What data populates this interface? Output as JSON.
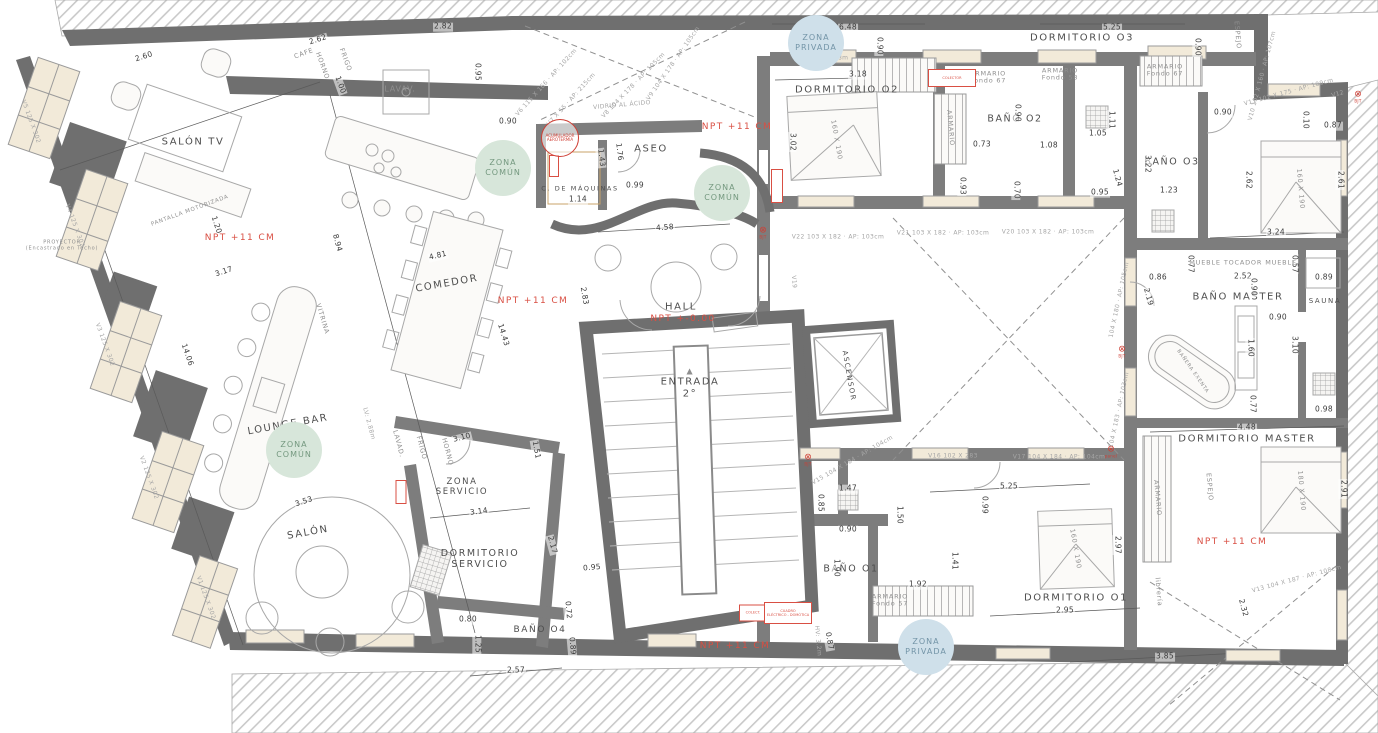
{
  "title": "Planta 2 - Distribución vivienda",
  "palette": {
    "wall": "#6f6f6f",
    "wall_inner": "#7d7d7d",
    "hatch": "#c9c9c9",
    "window_fill": "#f2ead9",
    "furniture": "#a8a8a8",
    "zone_common_bg": "#d7e6da",
    "zone_common_text": "#74987f",
    "zone_private_bg": "#cfe0ea",
    "zone_private_text": "#7394a7",
    "red": "#d94f43",
    "label": "#4e4e4e",
    "dim": "#3a3a3a",
    "tag": "#a6a6a6"
  },
  "rooms": [
    {
      "n": "room-salon-tv",
      "t": "SALÓN TV",
      "x": 193,
      "y": 142
    },
    {
      "n": "room-comedor",
      "t": "COMEDOR",
      "x": 447,
      "y": 284,
      "a": -10
    },
    {
      "n": "room-lounge-bar",
      "t": "LOUNGE BAR",
      "x": 288,
      "y": 425,
      "a": -10
    },
    {
      "n": "room-salon",
      "t": "SALÓN",
      "x": 308,
      "y": 533,
      "a": -10
    },
    {
      "n": "room-aseo",
      "t": "ASEO",
      "x": 651,
      "y": 149
    },
    {
      "n": "room-c-maquinas",
      "t": "C. DE MÁQUINAS",
      "x": 580,
      "y": 189,
      "s": 6.5
    },
    {
      "n": "room-hall",
      "t": "HALL",
      "x": 681,
      "y": 307
    },
    {
      "n": "room-entrada",
      "lines": [
        "ENTRADA",
        "2°"
      ],
      "x": 690,
      "y": 388
    },
    {
      "n": "room-ascensor",
      "t": "ASCENSOR",
      "x": 849,
      "y": 376,
      "a": 80,
      "s": 7
    },
    {
      "n": "room-zona-servicio",
      "lines": [
        "ZONA",
        "SERVICIO"
      ],
      "x": 462,
      "y": 488,
      "s": 8.5
    },
    {
      "n": "room-dormitorio-servicio",
      "lines": [
        "DORMITORIO",
        "SERVICIO"
      ],
      "x": 480,
      "y": 560,
      "s": 9.5
    },
    {
      "n": "room-bano-o4",
      "t": "BAÑO O4",
      "x": 540,
      "y": 630,
      "s": 9
    },
    {
      "n": "room-dormitorio-o2",
      "t": "DORMITORIO O2",
      "x": 847,
      "y": 90
    },
    {
      "n": "room-bano-o2",
      "t": "BAÑO O2",
      "x": 1015,
      "y": 120,
      "s": 9.5
    },
    {
      "n": "room-dormitorio-o3",
      "t": "DORMITORIO O3",
      "x": 1082,
      "y": 38
    },
    {
      "n": "room-bano-o3",
      "t": "BAÑO O3",
      "x": 1172,
      "y": 163,
      "s": 9.5
    },
    {
      "n": "room-bano-master",
      "t": "BAÑO MASTER",
      "x": 1238,
      "y": 297
    },
    {
      "n": "room-sauna",
      "t": "SAUNA",
      "x": 1325,
      "y": 301,
      "s": 7
    },
    {
      "n": "room-dormitorio-master",
      "t": "DORMITORIO MASTER",
      "x": 1247,
      "y": 439
    },
    {
      "n": "room-bano-o1",
      "t": "BAÑO O1",
      "x": 851,
      "y": 570,
      "s": 9.5
    },
    {
      "n": "room-dormitorio-o1",
      "t": "DORMITORIO O1",
      "x": 1076,
      "y": 598
    }
  ],
  "zones": [
    {
      "n": "zone-comun-cocina",
      "l1": "ZONA",
      "l2": "COMÚN",
      "x": 503,
      "y": 168,
      "type": "common"
    },
    {
      "n": "zone-comun-hall",
      "l1": "ZONA",
      "l2": "COMÚN",
      "x": 722,
      "y": 193,
      "type": "common"
    },
    {
      "n": "zone-comun-lounge",
      "l1": "ZONA",
      "l2": "COMÚN",
      "x": 294,
      "y": 450,
      "type": "common"
    },
    {
      "n": "zone-privada-top",
      "l1": "ZONA",
      "l2": "PRIVADA",
      "x": 816,
      "y": 43,
      "type": "private"
    },
    {
      "n": "zone-privada-bottom",
      "l1": "ZONA",
      "l2": "PRIVADA",
      "x": 926,
      "y": 647,
      "type": "private"
    }
  ],
  "npt": [
    {
      "t": "NPT +11 CM",
      "x": 240,
      "y": 238
    },
    {
      "t": "NPT +11 CM",
      "x": 533,
      "y": 301
    },
    {
      "t": "NPT +11 CM",
      "x": 737,
      "y": 127
    },
    {
      "t": "NPT +11 CM",
      "x": 735,
      "y": 646
    },
    {
      "t": "NPT +11 CM",
      "x": 1232,
      "y": 542
    },
    {
      "t": "NPT +-0.00",
      "x": 683,
      "y": 319
    }
  ],
  "dims": [
    {
      "t": "2.82",
      "x": 443,
      "y": 27
    },
    {
      "t": "2.62",
      "x": 318,
      "y": 40,
      "a": -18
    },
    {
      "t": "2.60",
      "x": 144,
      "y": 57,
      "a": -18
    },
    {
      "t": "1.00",
      "x": 340,
      "y": 85,
      "a": 70
    },
    {
      "t": "0.95",
      "x": 477,
      "y": 72,
      "a": 90
    },
    {
      "t": "0.90",
      "x": 508,
      "y": 122
    },
    {
      "t": "1.20",
      "x": 216,
      "y": 225,
      "a": 72
    },
    {
      "t": "8.94",
      "x": 337,
      "y": 243,
      "a": 75
    },
    {
      "t": "3.17",
      "x": 224,
      "y": 272,
      "a": -18
    },
    {
      "t": "14.06",
      "x": 187,
      "y": 355,
      "a": 71
    },
    {
      "t": "14.43",
      "x": 503,
      "y": 335,
      "a": 73
    },
    {
      "t": "4.81",
      "x": 438,
      "y": 256,
      "a": -13
    },
    {
      "t": "2.83",
      "x": 584,
      "y": 296,
      "a": 80
    },
    {
      "t": "4.58",
      "x": 665,
      "y": 228,
      "a": -4
    },
    {
      "t": "1.14",
      "x": 578,
      "y": 200
    },
    {
      "t": "0.99",
      "x": 635,
      "y": 186
    },
    {
      "t": "1.76",
      "x": 619,
      "y": 152,
      "a": 83
    },
    {
      "t": "1.43",
      "x": 601,
      "y": 158,
      "a": 83
    },
    {
      "t": "1.16",
      "x": 831,
      "y": 45
    },
    {
      "t": "6.48",
      "x": 848,
      "y": 28
    },
    {
      "t": "0.90",
      "x": 879,
      "y": 46,
      "a": 90
    },
    {
      "t": "3.18",
      "x": 858,
      "y": 75
    },
    {
      "t": "3.02",
      "x": 792,
      "y": 142,
      "a": 90
    },
    {
      "t": "5.25",
      "x": 1112,
      "y": 28
    },
    {
      "t": "0.90",
      "x": 1197,
      "y": 47,
      "a": 90
    },
    {
      "t": "0.73",
      "x": 982,
      "y": 145
    },
    {
      "t": "1.08",
      "x": 1049,
      "y": 146
    },
    {
      "t": "0.90",
      "x": 1017,
      "y": 113,
      "a": 90
    },
    {
      "t": "0.70",
      "x": 1016,
      "y": 190,
      "a": 90
    },
    {
      "t": "1.05",
      "x": 1098,
      "y": 134
    },
    {
      "t": "1.11",
      "x": 1111,
      "y": 120,
      "a": 90
    },
    {
      "t": "0.95",
      "x": 1100,
      "y": 193
    },
    {
      "t": "0.93",
      "x": 962,
      "y": 186,
      "a": 90
    },
    {
      "t": "1.23",
      "x": 1169,
      "y": 191
    },
    {
      "t": "3.22",
      "x": 1147,
      "y": 164,
      "a": 90
    },
    {
      "t": "1.24",
      "x": 1117,
      "y": 178,
      "a": 75
    },
    {
      "t": "0.90",
      "x": 1223,
      "y": 113
    },
    {
      "t": "0.10",
      "x": 1305,
      "y": 120,
      "a": 90
    },
    {
      "t": "0.87",
      "x": 1333,
      "y": 126
    },
    {
      "t": "2.62",
      "x": 1248,
      "y": 180,
      "a": 90
    },
    {
      "t": "2.61",
      "x": 1340,
      "y": 180,
      "a": 90
    },
    {
      "t": "3.24",
      "x": 1276,
      "y": 233
    },
    {
      "t": "0.86",
      "x": 1158,
      "y": 278
    },
    {
      "t": "0.77",
      "x": 1190,
      "y": 264,
      "a": 90
    },
    {
      "t": "2.52",
      "x": 1243,
      "y": 277
    },
    {
      "t": "0.57",
      "x": 1294,
      "y": 264,
      "a": 90
    },
    {
      "t": "0.89",
      "x": 1324,
      "y": 278
    },
    {
      "t": "0.90",
      "x": 1253,
      "y": 287,
      "a": 90
    },
    {
      "t": "2.19",
      "x": 1148,
      "y": 297,
      "a": 75
    },
    {
      "t": "0.90",
      "x": 1278,
      "y": 318
    },
    {
      "t": "1.60",
      "x": 1250,
      "y": 348,
      "a": 90
    },
    {
      "t": "3.10",
      "x": 1294,
      "y": 345,
      "a": 90
    },
    {
      "t": "0.77",
      "x": 1252,
      "y": 404,
      "a": 90
    },
    {
      "t": "0.98",
      "x": 1324,
      "y": 410
    },
    {
      "t": "4.48",
      "x": 1247,
      "y": 428
    },
    {
      "t": "2.91",
      "x": 1343,
      "y": 489,
      "a": 90
    },
    {
      "t": "2.32",
      "x": 1243,
      "y": 608,
      "a": 75
    },
    {
      "t": "3.85",
      "x": 1165,
      "y": 657
    },
    {
      "t": "5.25",
      "x": 1009,
      "y": 487
    },
    {
      "t": "0.99",
      "x": 984,
      "y": 505,
      "a": 90
    },
    {
      "t": "2.97",
      "x": 1117,
      "y": 545,
      "a": 90
    },
    {
      "t": "2.95",
      "x": 1065,
      "y": 611
    },
    {
      "t": "1.47",
      "x": 848,
      "y": 489
    },
    {
      "t": "0.85",
      "x": 820,
      "y": 503,
      "a": 90
    },
    {
      "t": "1.50",
      "x": 899,
      "y": 515,
      "a": 90
    },
    {
      "t": "0.90",
      "x": 848,
      "y": 530
    },
    {
      "t": "1.90",
      "x": 836,
      "y": 568,
      "a": 90
    },
    {
      "t": "1.92",
      "x": 918,
      "y": 585
    },
    {
      "t": "1.41",
      "x": 954,
      "y": 561,
      "a": 90
    },
    {
      "t": "0.87",
      "x": 829,
      "y": 641,
      "a": 80
    },
    {
      "t": "3.53",
      "x": 304,
      "y": 502,
      "a": -18
    },
    {
      "t": "3.14",
      "x": 479,
      "y": 512,
      "a": -8
    },
    {
      "t": "2.17",
      "x": 552,
      "y": 545,
      "a": 75
    },
    {
      "t": "0.95",
      "x": 592,
      "y": 568,
      "a": -5
    },
    {
      "t": "0.72",
      "x": 568,
      "y": 610,
      "a": 85
    },
    {
      "t": "0.80",
      "x": 468,
      "y": 620
    },
    {
      "t": "1.25",
      "x": 477,
      "y": 644,
      "a": 90
    },
    {
      "t": "2.57",
      "x": 516,
      "y": 671
    },
    {
      "t": "0.89",
      "x": 572,
      "y": 646,
      "a": 85
    },
    {
      "t": "3.10",
      "x": 462,
      "y": 438,
      "a": -14
    },
    {
      "t": "1.51",
      "x": 536,
      "y": 450,
      "a": 80
    }
  ],
  "tags": [
    {
      "t": "V1 125 X 302",
      "x": 205,
      "y": 598,
      "a": 70
    },
    {
      "t": "V2 125 X 302",
      "x": 148,
      "y": 478,
      "a": 70
    },
    {
      "t": "V3 125 X 302",
      "x": 104,
      "y": 345,
      "a": 70
    },
    {
      "t": "V4 125 X 302",
      "x": 74,
      "y": 226,
      "a": 70
    },
    {
      "t": "V5 125 X 302",
      "x": 30,
      "y": 122,
      "a": 70
    },
    {
      "t": "V6 115 X 166 · AP: 102cm",
      "x": 547,
      "y": 83,
      "a": -48
    },
    {
      "t": "V7 X 55 · AP: 215cm",
      "x": 572,
      "y": 100,
      "a": -48
    },
    {
      "t": "V8 104 X 178 · AP: 105cm",
      "x": 634,
      "y": 86,
      "a": -46
    },
    {
      "t": "V9 104 X 178 · AP: 105cm",
      "x": 674,
      "y": 64,
      "a": -55
    },
    {
      "t": "V10 102 X 160 · AP: 107cm",
      "x": 1263,
      "y": 76,
      "a": -75
    },
    {
      "t": "V11 102 X 175 · AP: 109cm",
      "x": 1289,
      "y": 93,
      "a": -15
    },
    {
      "t": "V12",
      "x": 1338,
      "y": 95,
      "a": -15
    },
    {
      "t": "V13 104 X 187 · AP: 108cm",
      "x": 1297,
      "y": 580,
      "a": -15
    },
    {
      "t": "104 X 180 · AP: 105cm",
      "x": 1120,
      "y": 300,
      "a": -78
    },
    {
      "t": "104 X 183 · AP: 103cm",
      "x": 1120,
      "y": 410,
      "a": -78
    },
    {
      "t": "V15 104 X 184 · AP: 104cm",
      "x": 853,
      "y": 461,
      "a": -30
    },
    {
      "t": "V16 102 X 283",
      "x": 953,
      "y": 457
    },
    {
      "t": "V17 104 X 184 · AP: 104cm",
      "x": 1059,
      "y": 458
    },
    {
      "t": "V20 103 X 182 · AP: 103cm",
      "x": 1048,
      "y": 233
    },
    {
      "t": "V21 103 X 182 · AP: 103cm",
      "x": 943,
      "y": 234
    },
    {
      "t": "V22 103 X 182 · AP: 103cm",
      "x": 838,
      "y": 238
    },
    {
      "t": "V19",
      "x": 793,
      "y": 282,
      "a": 85
    },
    {
      "t": "HV: 3.18m",
      "x": 831,
      "y": 59
    },
    {
      "t": "HV: 3.2m",
      "x": 817,
      "y": 641,
      "a": 85
    },
    {
      "t": "LV: 2.88m",
      "x": 368,
      "y": 424,
      "a": 75
    },
    {
      "t": "VIDRIO AL ÁCIDO",
      "x": 622,
      "y": 106,
      "a": -5
    }
  ],
  "fixtures": [
    {
      "n": "fixture-lavavajillas",
      "t": "LAVAV.",
      "x": 400,
      "y": 89,
      "s": 8
    },
    {
      "n": "fixture-cafe",
      "t": "CAFE",
      "x": 304,
      "y": 54,
      "a": -20
    },
    {
      "n": "fixture-frigo",
      "t": "FRIGO",
      "x": 345,
      "y": 60,
      "a": 70
    },
    {
      "n": "fixture-horno",
      "t": "HORNO",
      "x": 322,
      "y": 66,
      "a": 70
    },
    {
      "n": "fixture-lavadora",
      "t": "LAVAD.",
      "x": 398,
      "y": 444,
      "a": 75
    },
    {
      "n": "fixture-frigo-servicio",
      "t": "FRIGO",
      "x": 421,
      "y": 448,
      "a": 75
    },
    {
      "n": "fixture-horno-servicio",
      "t": "HORNO",
      "x": 447,
      "y": 452,
      "a": 75
    },
    {
      "n": "fixture-armario-o2",
      "lines": [
        "ARMARIO",
        "Fondo 67"
      ],
      "x": 988,
      "y": 78
    },
    {
      "n": "fixture-armario-o2b",
      "lines": [
        "ARMARIO",
        "Fondo 58"
      ],
      "x": 1060,
      "y": 75
    },
    {
      "n": "fixture-armario-o3",
      "lines": [
        "ARMARIO",
        "Fondo 67"
      ],
      "x": 1165,
      "y": 71
    },
    {
      "n": "fixture-armario-vert",
      "t": "ARMARIO",
      "x": 950,
      "y": 128,
      "a": 85
    },
    {
      "n": "fixture-armario-o1",
      "lines": [
        "ARMARIO",
        "Fondo 57"
      ],
      "x": 890,
      "y": 601
    },
    {
      "n": "fixture-armario-master",
      "t": "ARMARIO",
      "x": 1157,
      "y": 498,
      "a": 85
    },
    {
      "n": "fixture-espejo-o3",
      "t": "ESPEJO",
      "x": 1237,
      "y": 35,
      "a": 85
    },
    {
      "n": "fixture-espejo-master",
      "t": "ESPEJO",
      "x": 1209,
      "y": 487,
      "a": 85
    },
    {
      "n": "fixture-libreria",
      "t": "librería",
      "x": 1158,
      "y": 592,
      "a": 85
    },
    {
      "n": "fixture-mueble-1",
      "t": "MUEBLE",
      "x": 1205,
      "y": 263
    },
    {
      "n": "fixture-tocador",
      "t": "TOCADOR",
      "x": 1243,
      "y": 263
    },
    {
      "n": "fixture-mueble-2",
      "t": "MUEBLE",
      "x": 1281,
      "y": 263
    },
    {
      "n": "fixture-banera",
      "t": "BAÑERA EXENTA",
      "x": 1192,
      "y": 372,
      "a": 55,
      "s": 5
    },
    {
      "n": "fixture-cama-o2",
      "t": "160 X 190",
      "x": 836,
      "y": 140,
      "a": 80
    },
    {
      "n": "fixture-cama-o3",
      "t": "160 X 190",
      "x": 1300,
      "y": 189,
      "a": 85
    },
    {
      "n": "fixture-cama-o1",
      "t": "160 X 190",
      "x": 1075,
      "y": 549,
      "a": 80
    },
    {
      "n": "fixture-cama-master",
      "t": "180 X 190",
      "x": 1301,
      "y": 491,
      "a": 85
    },
    {
      "n": "fixture-pantalla",
      "t": "PANTALLA MOTORIZADA",
      "x": 190,
      "y": 211,
      "a": -20,
      "s": 5.5
    },
    {
      "n": "fixture-proyector",
      "lines": [
        "PROYECTOR",
        "(Encastrado en Techo)"
      ],
      "x": 62,
      "y": 246,
      "s": 5
    },
    {
      "n": "fixture-vitrina",
      "t": "VITRINA",
      "x": 322,
      "y": 319,
      "a": 73
    },
    {
      "n": "entrada-arrow",
      "t": "▲",
      "x": 690,
      "y": 371,
      "s": 8
    }
  ],
  "red_annotations": [
    {
      "n": "colector-o2",
      "lines": [
        "COLECTOR"
      ],
      "x": 952,
      "y": 78,
      "w": 46,
      "h": 16
    },
    {
      "n": "colector-entrada",
      "lines": [
        "COLECT."
      ],
      "x": 753,
      "y": 613,
      "w": 26,
      "h": 15
    },
    {
      "n": "cuadro-electrico",
      "lines": [
        "CUADRO",
        "ELÉCTRICO - DOMÓTICA"
      ],
      "x": 788,
      "y": 613,
      "w": 46,
      "h": 20
    },
    {
      "n": "riser-hall",
      "lines": [
        ""
      ],
      "x": 777,
      "y": 186,
      "w": 10,
      "h": 32
    },
    {
      "n": "riser-maquinas",
      "lines": [
        ""
      ],
      "x": 554,
      "y": 166,
      "w": 8,
      "h": 20
    },
    {
      "n": "riser-servicio",
      "lines": [
        ""
      ],
      "x": 401,
      "y": 492,
      "w": 9,
      "h": 22
    }
  ],
  "red_circle": {
    "n": "acumulador-aerotermia",
    "lines": [
      "ACUMULADOR",
      "AEROTERMIA"
    ],
    "x": 560,
    "y": 138
  },
  "markers": [
    {
      "t": "BJT",
      "x": 763,
      "y": 233
    },
    {
      "t": "BJT",
      "x": 1122,
      "y": 352
    },
    {
      "t": "BJT",
      "x": 1358,
      "y": 97
    },
    {
      "t": "BJT",
      "x": 808,
      "y": 460
    },
    {
      "t": "panel",
      "x": 1111,
      "y": 452
    }
  ]
}
